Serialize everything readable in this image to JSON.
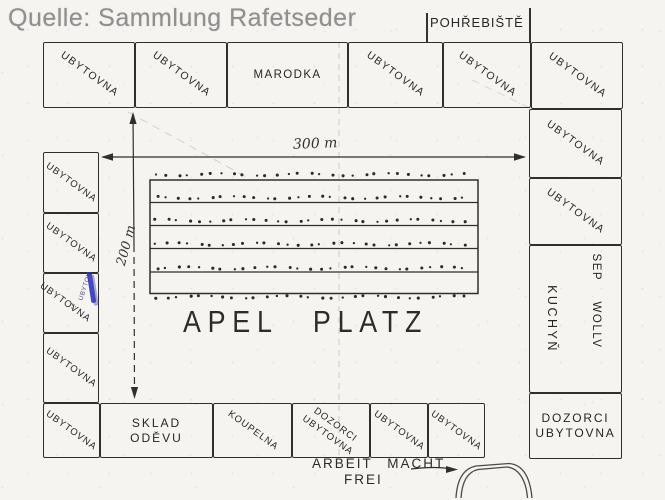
{
  "title_overlay": {
    "text": "Quelle: Sammlung Rafetseder"
  },
  "cemetery": {
    "label": "POHŘEBIŠTĚ"
  },
  "top_row": [
    "UBYTOVNA",
    "UBYTOVNA",
    "MARODKA",
    "UBYTOVNA",
    "UBYTOVNA",
    "UBYTOVNA"
  ],
  "left_column": [
    "UBYTOVNA",
    "UBYTOVNA",
    "UBYTOVNA",
    "UBYTOVNA"
  ],
  "right_column": {
    "box1": "UBYTOVNA",
    "box2": "UBYTOVNA",
    "kitchen_label": "KUCHYŇ",
    "sep_woll_label": "SEP WOLLV",
    "guard_line1": "DOZORCI",
    "guard_line2": "UBYTOVNA"
  },
  "bottom_row": {
    "box1": "UBYTOVNA",
    "clothes_store_line1": "SKLAD",
    "clothes_store_line2": "ODĚVU",
    "bath": "KOUPELNA",
    "guard_line1": "DOZORCI",
    "guard_line2": "UBYTOVNA",
    "box5": "UBYTOVNA",
    "box6": "UBYTOVNA"
  },
  "field": {
    "label": "APEL PLATZ",
    "width_label": "300 m",
    "height_label": "200 m",
    "tree_rows": 6,
    "trees_per_row": 29
  },
  "gate": {
    "caption_line1": "ARBEIT MACHT",
    "caption_line2": "FREI"
  },
  "blue_annotation": {
    "text": "UBYTOV.",
    "initial": "J."
  },
  "colors": {
    "ink": "#2f2f2f",
    "paper": "#f5f4f0",
    "caption_gray": "#8f8f8f",
    "blue_ink": "#2b2bb5"
  }
}
